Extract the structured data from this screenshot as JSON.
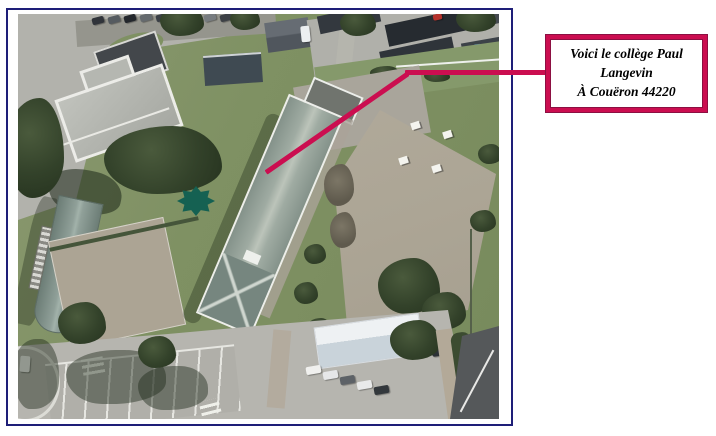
{
  "callout": {
    "lines": [
      "Voici le collège Paul",
      "Langevin",
      "À Couëron 44220"
    ]
  },
  "colors": {
    "accent_crimson": "#cb0e50",
    "callout_outline": "#8c1042",
    "photo_frame_border": "#1e1e78",
    "marker_teal": "#156152"
  }
}
